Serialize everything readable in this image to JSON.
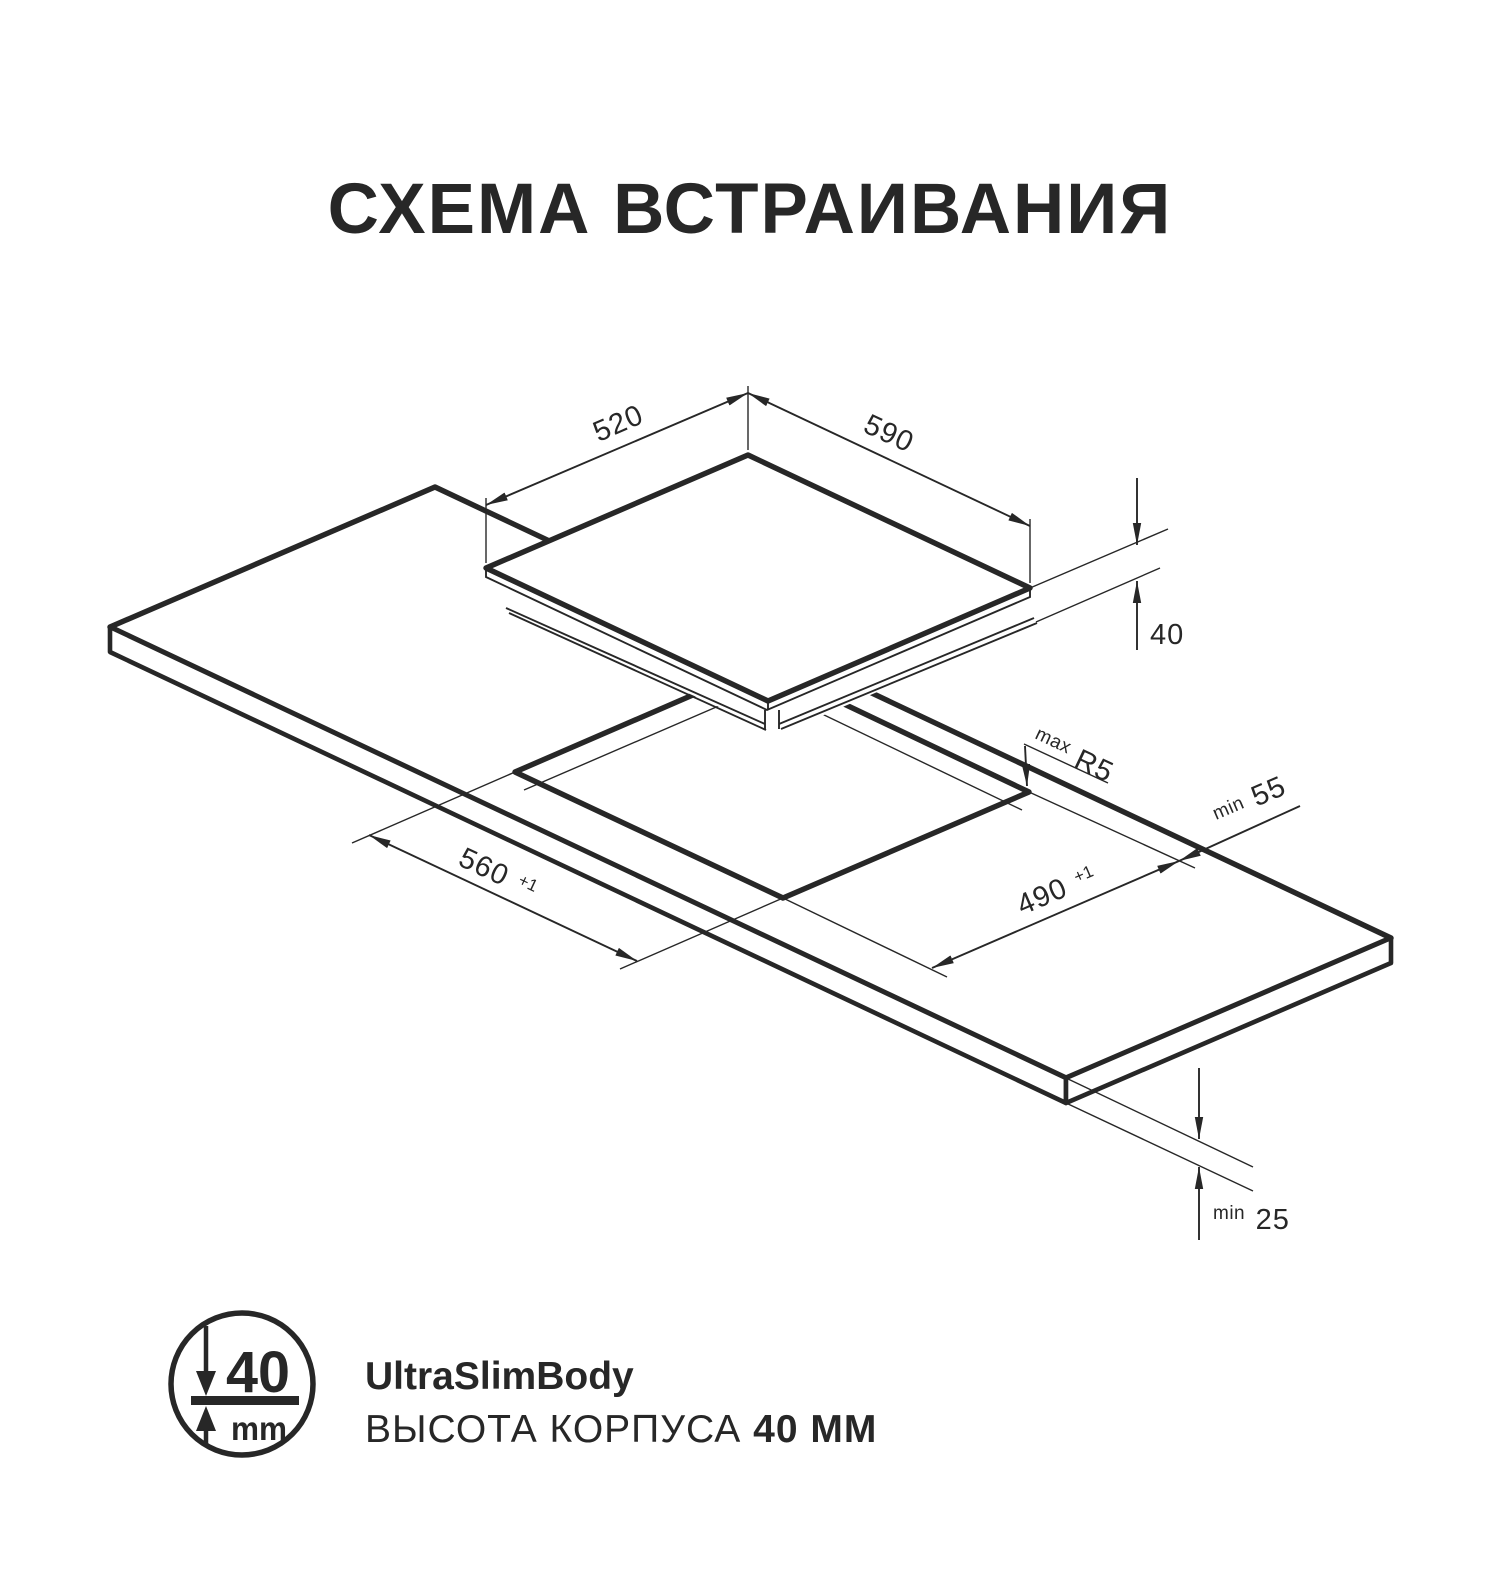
{
  "title": "СХЕМА ВСТРАИВАНИЯ",
  "diagram": {
    "hob_depth": "520",
    "hob_width": "590",
    "hob_height": "40",
    "corner_radius": {
      "prefix": "max",
      "value": "R5"
    },
    "edge_clearance": {
      "prefix": "min",
      "value": "55"
    },
    "cutout_length": {
      "value": "560",
      "tolerance": "+1"
    },
    "cutout_width": {
      "value": "490",
      "tolerance": "+1"
    },
    "worktop_thickness": {
      "prefix": "min",
      "value": "25"
    }
  },
  "feature": {
    "badge": {
      "value": "40",
      "unit": "mm",
      "down-arrow-icon": "arrow-down",
      "up-arrow-icon": "arrow-up"
    },
    "name": "UltraSlimBody",
    "description": "ВЫСОТА КОРПУСА ",
    "description_bold": "40 ММ"
  },
  "colors": {
    "ink": "#272727",
    "background": "#ffffff"
  }
}
